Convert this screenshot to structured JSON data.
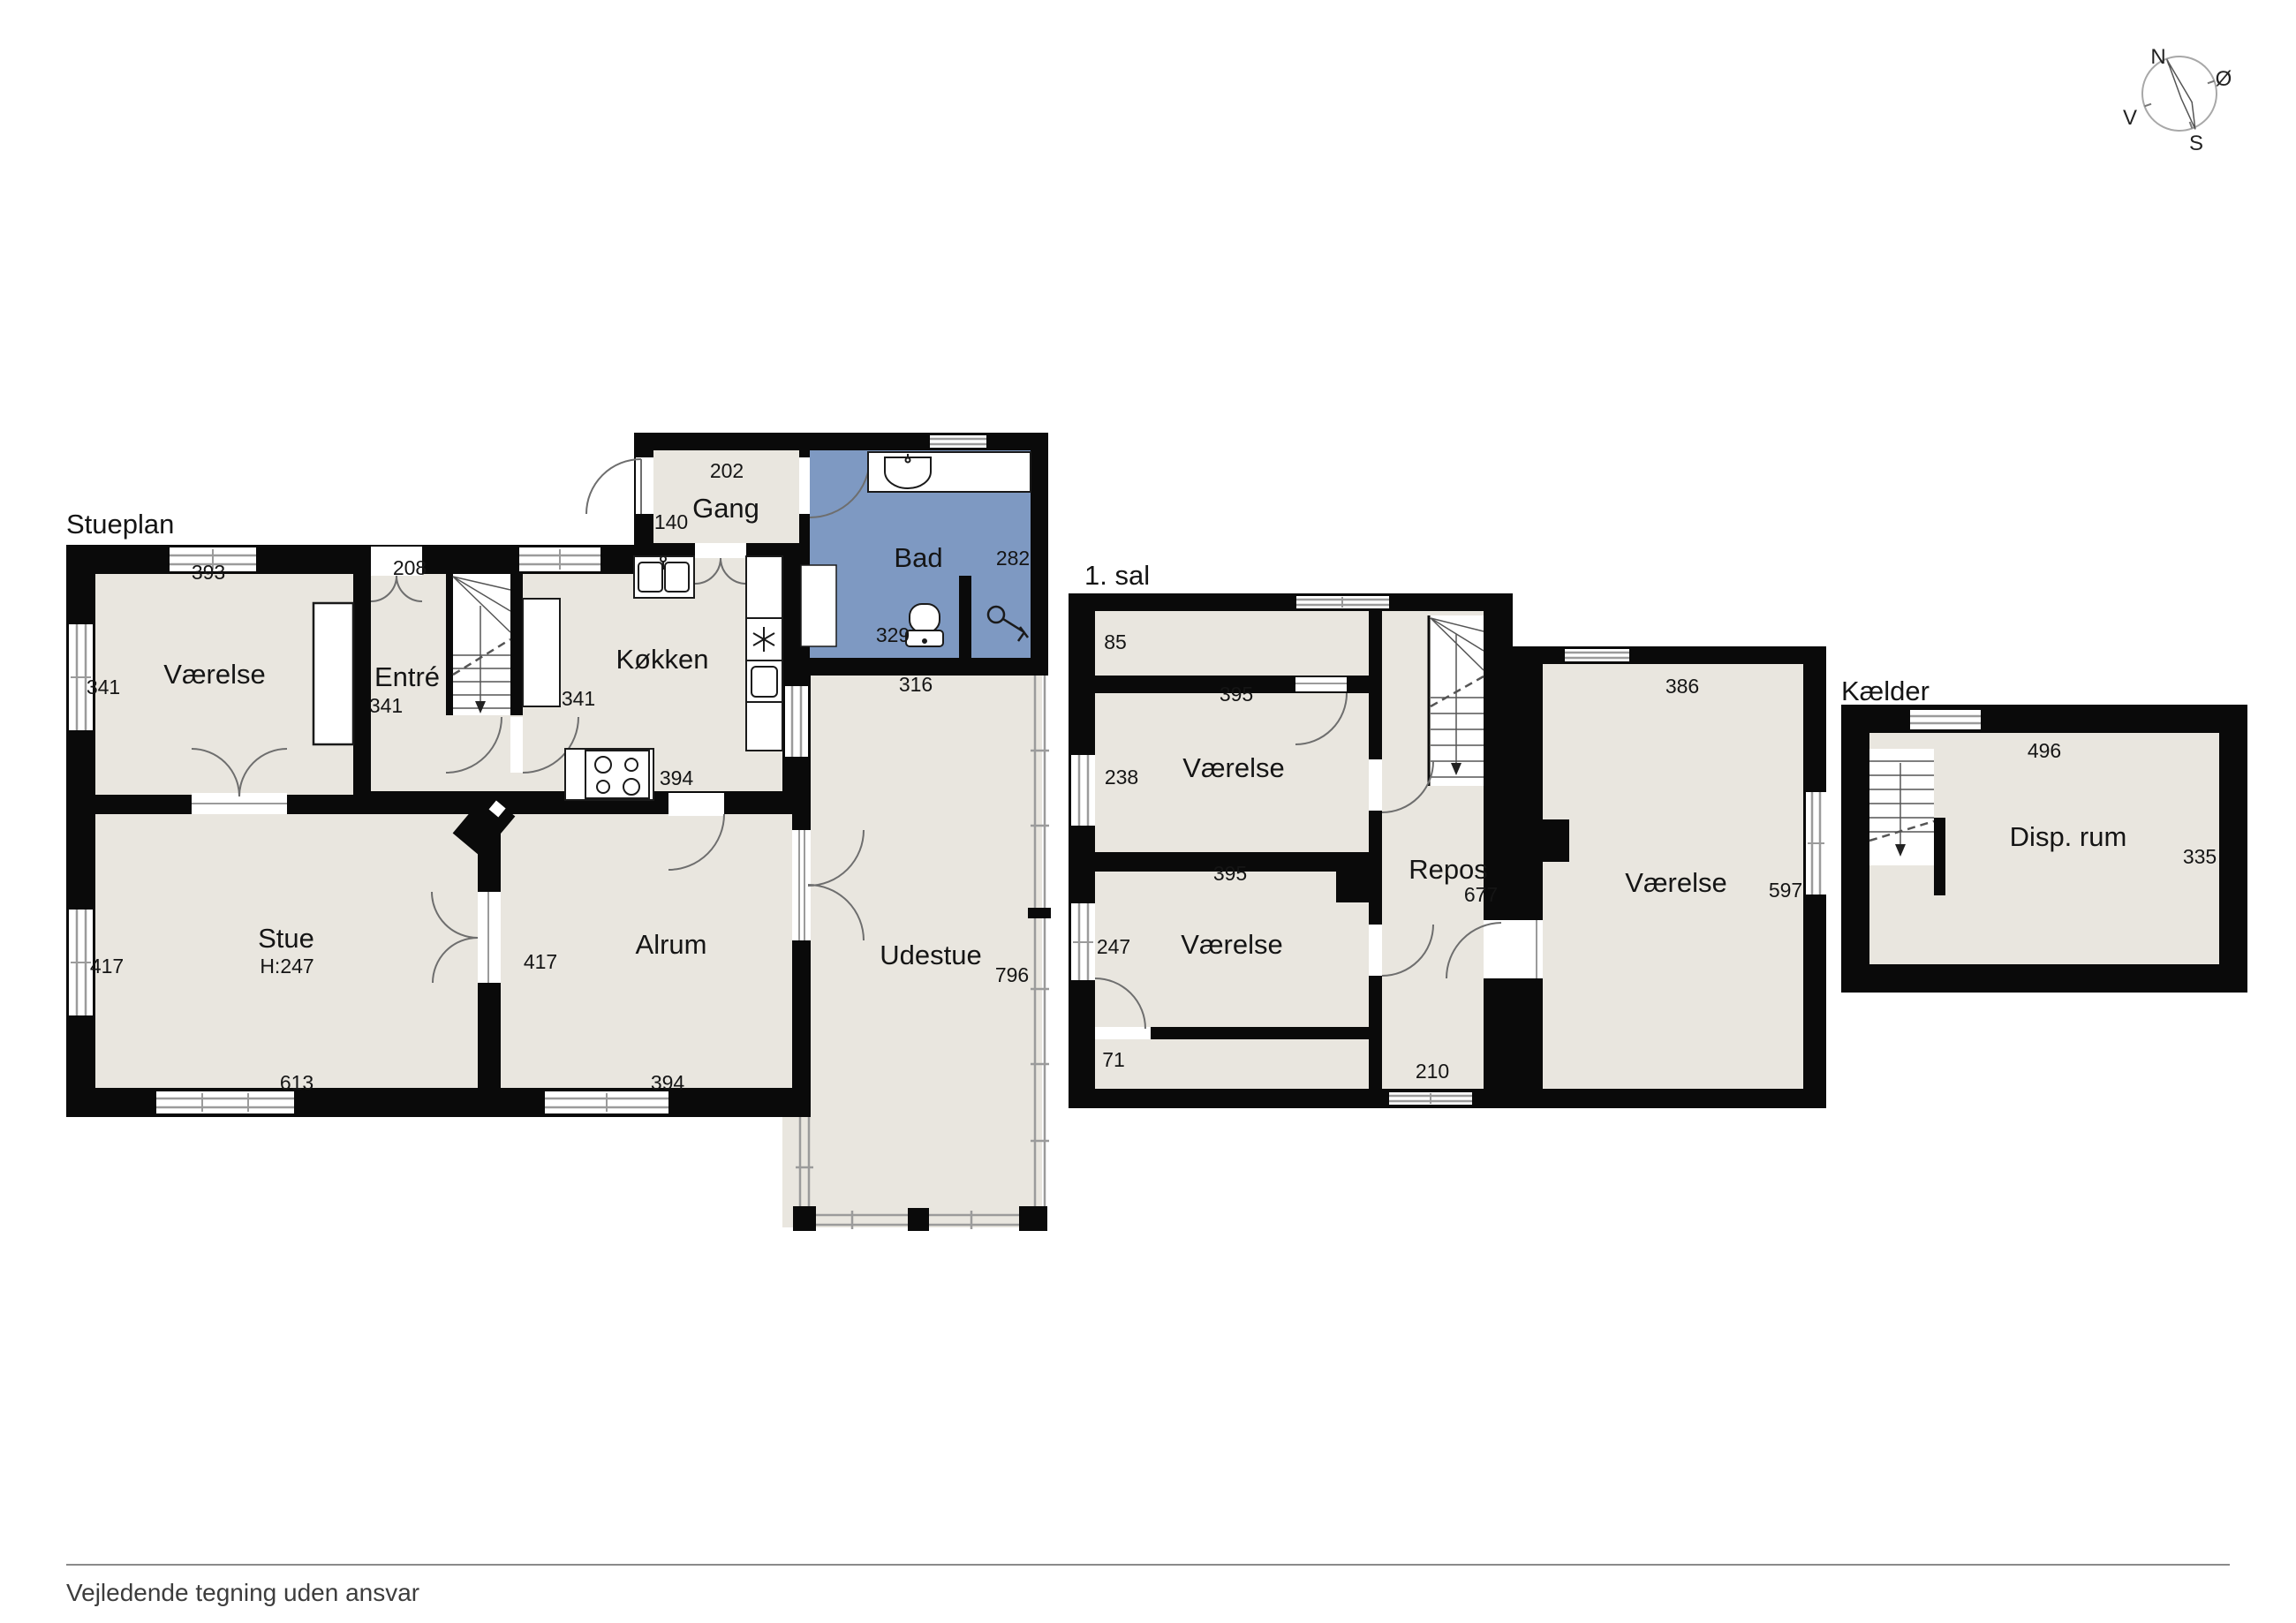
{
  "page": {
    "footer_note": "Vejledende tegning uden ansvar"
  },
  "compass": {
    "north": "N",
    "east": "Ø",
    "south": "S",
    "west": "V"
  },
  "colors": {
    "room_fill": "#e9e6df",
    "bath_fill": "#7e99c2",
    "wall": "#0a0a0a",
    "window_line": "#9b9b9b",
    "door_arc": "#6e6e6e"
  },
  "floors": [
    {
      "title": "Stueplan",
      "rooms": [
        {
          "name": "Værelse",
          "width": "393",
          "height": "341"
        },
        {
          "name": "Entré",
          "width": "208",
          "height": "341"
        },
        {
          "name": "Gang",
          "width": "202",
          "height": "140"
        },
        {
          "name": "Bad",
          "width": "282",
          "depth": "329"
        },
        {
          "name": "Køkken",
          "height": "341",
          "width": "394"
        },
        {
          "name": "Stue",
          "ceiling_height": "H:247",
          "height": "417",
          "width": "613"
        },
        {
          "name": "Alrum",
          "height": "417",
          "width": "394"
        },
        {
          "name": "Udestue",
          "width": "316",
          "height": "796"
        }
      ]
    },
    {
      "title": "1. sal",
      "rooms": [
        {
          "name": "Værelse",
          "width": "395",
          "height": "238",
          "hall_depth": "85"
        },
        {
          "name": "Værelse",
          "width": "395",
          "height": "247",
          "hall_depth": "71"
        },
        {
          "name": "Repos",
          "height": "677",
          "width": "210"
        },
        {
          "name": "Værelse",
          "width": "386",
          "height": "597"
        }
      ]
    },
    {
      "title": "Kælder",
      "rooms": [
        {
          "name": "Disp. rum",
          "width": "496",
          "height": "335"
        }
      ]
    }
  ]
}
